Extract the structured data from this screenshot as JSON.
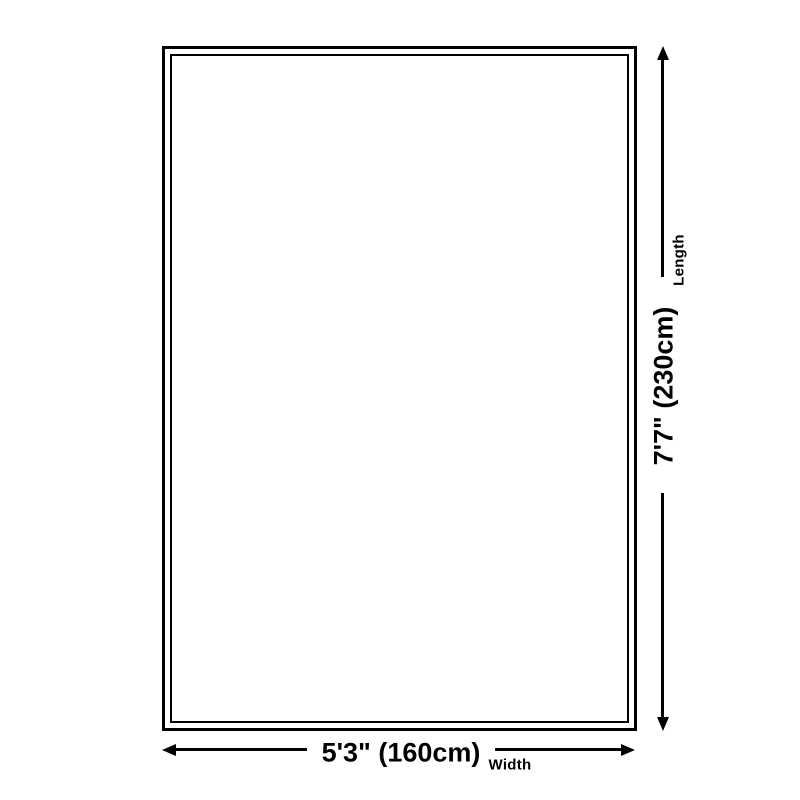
{
  "diagram": {
    "type": "product-dimension-diagram",
    "length_value": "7'7\" (230cm)",
    "length_label": "Length",
    "width_value": "5'3\" (160cm)",
    "width_label": "Width"
  },
  "colors": {
    "background": "#ffffff",
    "line": "#000000"
  }
}
